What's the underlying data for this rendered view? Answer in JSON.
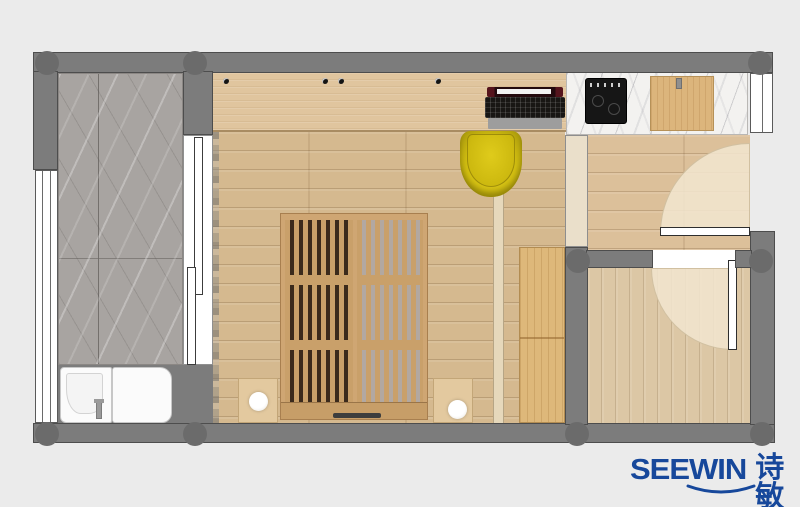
{
  "scene": {
    "type": "interior floor-plan rendering (top view)",
    "background": "#ebebeb"
  },
  "logo": {
    "latin": "SEEWIN",
    "chinese": "诗敏",
    "color": "#17489b"
  },
  "palette": {
    "wall_gray": "#7c7c7c",
    "wall_edge": "#4d4d4d",
    "column_gray": "#6b6b6b",
    "bedroom_floor_wood": "#d5b98f",
    "desk_wood": "#e0c59e",
    "wardrobe_wood": "#deb87a",
    "bed_slat_wood": "#c9a06a",
    "balcony_marble": "#a8a4a1",
    "counter_marble": "#f3f2f0",
    "chair_yellow": "#cdb90f",
    "bathroom_floor_wood": "#dcc7a5",
    "door_swing_area": "#f1e5ce",
    "cooktop_black": "#161616",
    "appliance_white": "#fbfbfb"
  },
  "objects": [
    "balcony-marble-floor",
    "left-window",
    "laundry-sink-unit",
    "laundry-machine-unit",
    "faucet",
    "sliding-door-panels",
    "curtain",
    "bedroom-wood-floor",
    "desk",
    "desk-grommets",
    "laptop",
    "yellow-desk-chair",
    "slatted-platform-bed",
    "nightstand-left",
    "nightstand-right",
    "bed-lamp-left",
    "bed-lamp-right",
    "glass-divider-track",
    "hallway-floor",
    "wardrobe-cabinet",
    "kitchen-marble-counter",
    "induction-cooktop",
    "counter-wood-cabinet",
    "entry-shoe-cabinet",
    "right-window",
    "entry-door-with-swing",
    "bathroom-door-with-swing",
    "bathroom-wood-floor",
    "structural-columns"
  ]
}
